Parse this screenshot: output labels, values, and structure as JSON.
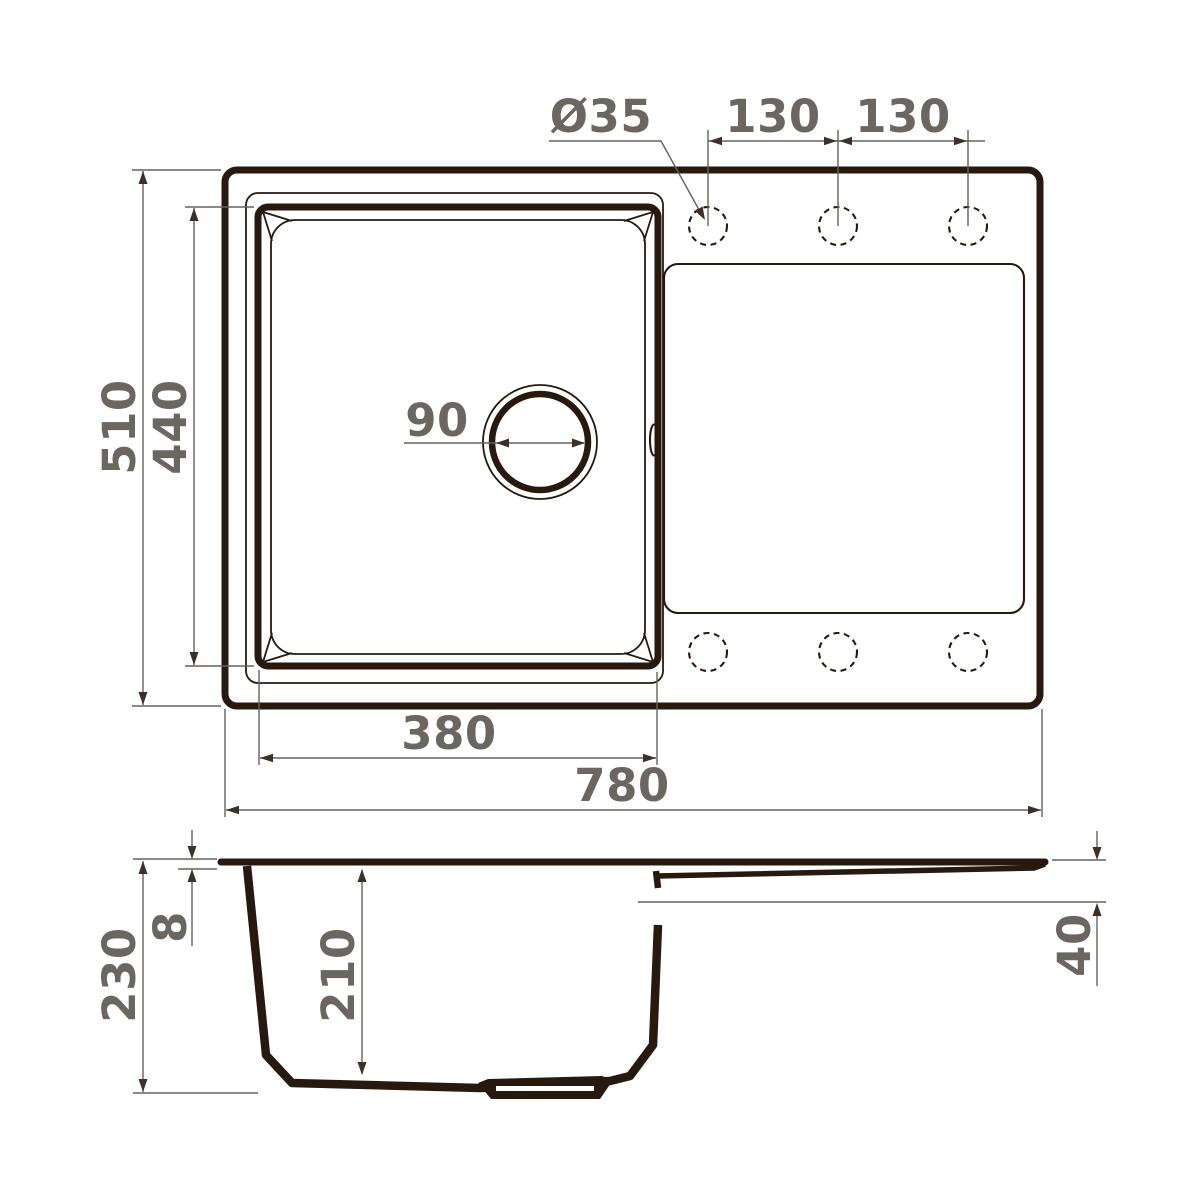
{
  "drawing": {
    "colors": {
      "line": "#27190e",
      "dim_line": "#66615b",
      "text": "#6c6660",
      "background": "#ffffff"
    },
    "top_view": {
      "faucet_hole_diameter": "Ø35",
      "faucet_spacing_left": "130",
      "faucet_spacing_right": "130",
      "overall_depth": "510",
      "bowl_length": "440",
      "drain_diameter": "90",
      "bowl_width": "380",
      "overall_width": "780"
    },
    "section_view": {
      "overall_height": "230",
      "rim_thickness": "8",
      "bowl_depth": "210",
      "drainboard_drop": "40"
    }
  }
}
